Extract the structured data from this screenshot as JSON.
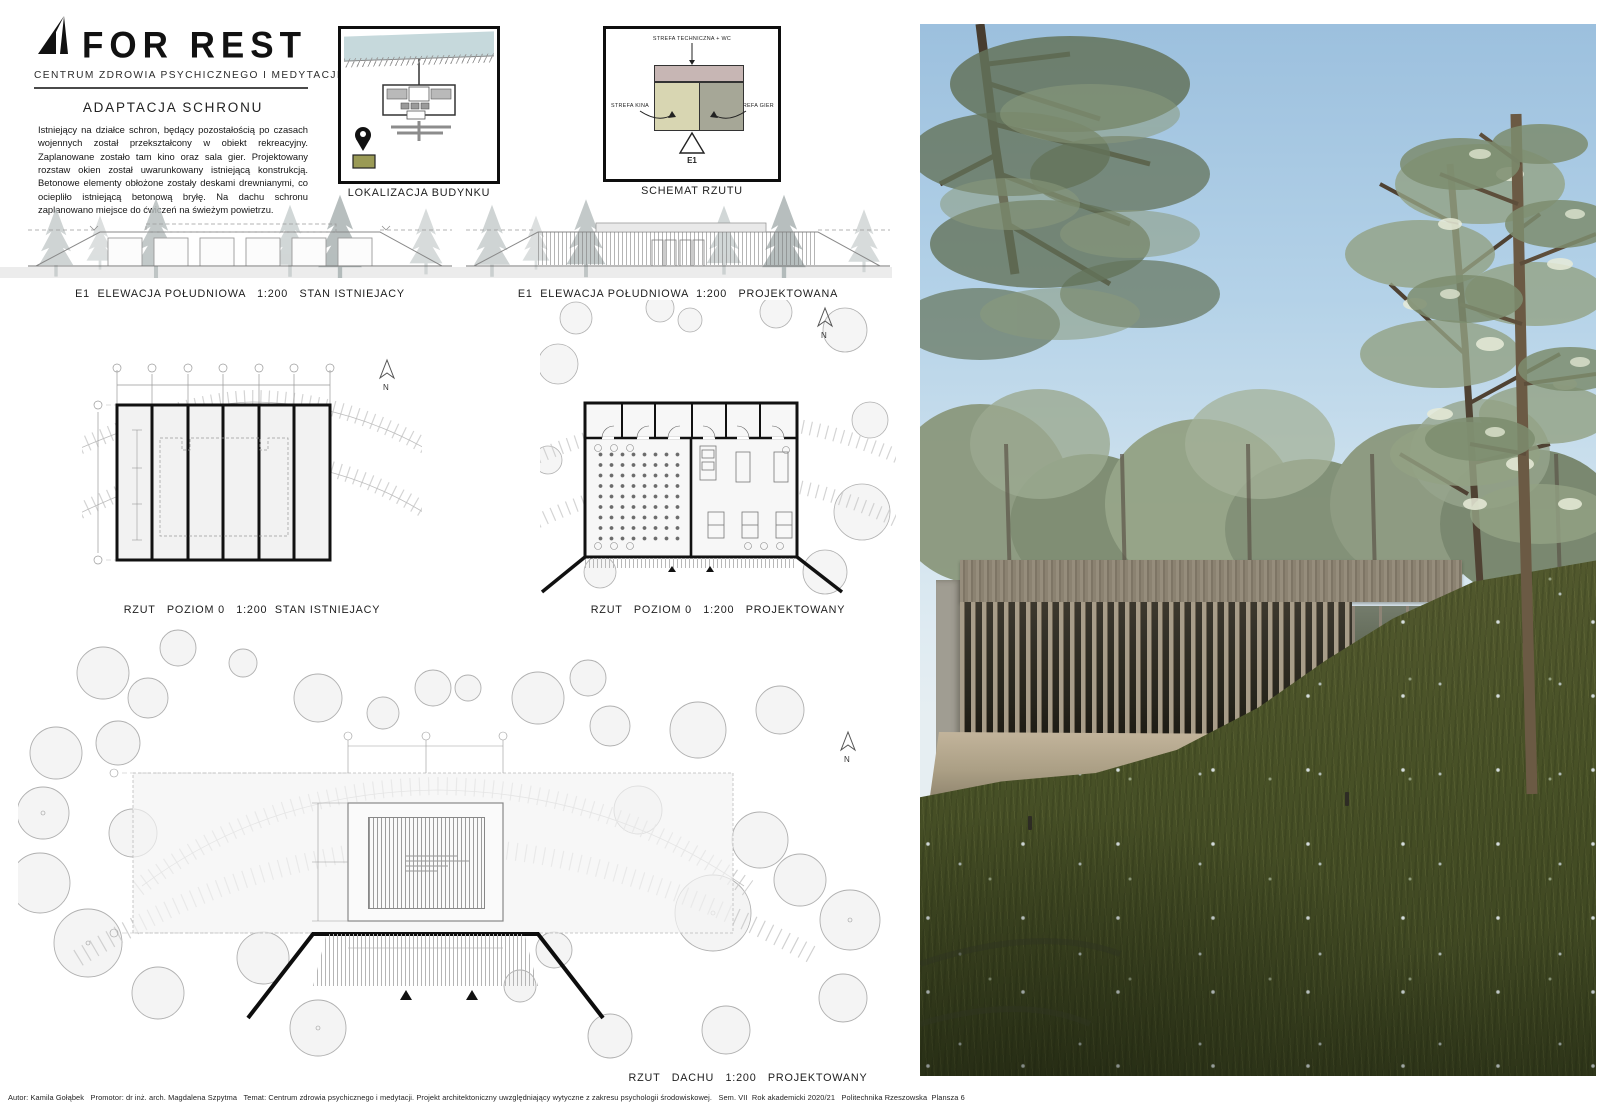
{
  "board": {
    "logo": {
      "text": "FOR REST",
      "subtitle": "CENTRUM ZDROWIA PSYCHICZNEGO I MEDYTACJI"
    },
    "intro": {
      "heading": "ADAPTACJA SCHRONU",
      "body": "Istniejący na działce schron, będący pozostałością po czasach wojennych został przekształcony w obiekt rekreacyjny. Zaplanowane zostało tam kino oraz sala gier. Projektowany rozstaw okien został uwarunkowany istniejącą konstrukcją. Betonowe elementy obłożone zostały deskami drewnianymi, co ociepliło istniejącą betonową bryłę. Na dachu schronu zaplanowano miejsce do ćwiczeń na świeżym powietrzu."
    },
    "location": {
      "caption": "LOKALIZACJA BUDYNKU"
    },
    "schematic": {
      "caption": "SCHEMAT RZUTU",
      "zone_technical": "STREFA TECHNICZNA + WC",
      "zone_cinema": "STREFA KINA",
      "zone_games": "STREFA GIER",
      "marker": "E1",
      "colors": {
        "technical": "#c7b6b4",
        "cinema": "#d8d6b2",
        "games": "#a6a797"
      }
    },
    "captions": {
      "elevation_existing": "E1  ELEWACJA POŁUDNIOWA   1:200   STAN ISTNIEJACY",
      "elevation_proposed": "E1  ELEWACJA POŁUDNIOWA  1:200   PROJEKTOWANA",
      "plan_existing": "RZUT   POZIOM 0   1:200  STAN ISTNIEJACY",
      "plan_proposed": "RZUT   POZIOM 0   1:200   PROJEKTOWANY",
      "roof": "RZUT   DACHU   1:200   PROJEKTOWANY"
    },
    "north_label": "N",
    "footer": "Autor: Kamila Gołąbek   Promotor: dr inż. arch. Magdalena Szpytma   Temat: Centrum zdrowia psychicznego i medytacji. Projekt architektoniczny uwzględniający wytyczne z zakresu psychologii środowiskowej.   Sem. VII  Rok akademicki 2020/21   Politechnika Rzeszowska  Plansza 6"
  },
  "render_palette": {
    "sky": "#9cc0de",
    "sky_horizon": "#e6eef2",
    "foliage_dark": "#5f6f52",
    "foliage_light": "#9fae92",
    "trunk": "#4a3f30",
    "wood_slats": "#a89d89",
    "interior_shadow": "#27251c",
    "concrete": "#a09d92",
    "deck": "#c2b49b",
    "grass": "#555b30",
    "grass_dark": "#39411f"
  }
}
